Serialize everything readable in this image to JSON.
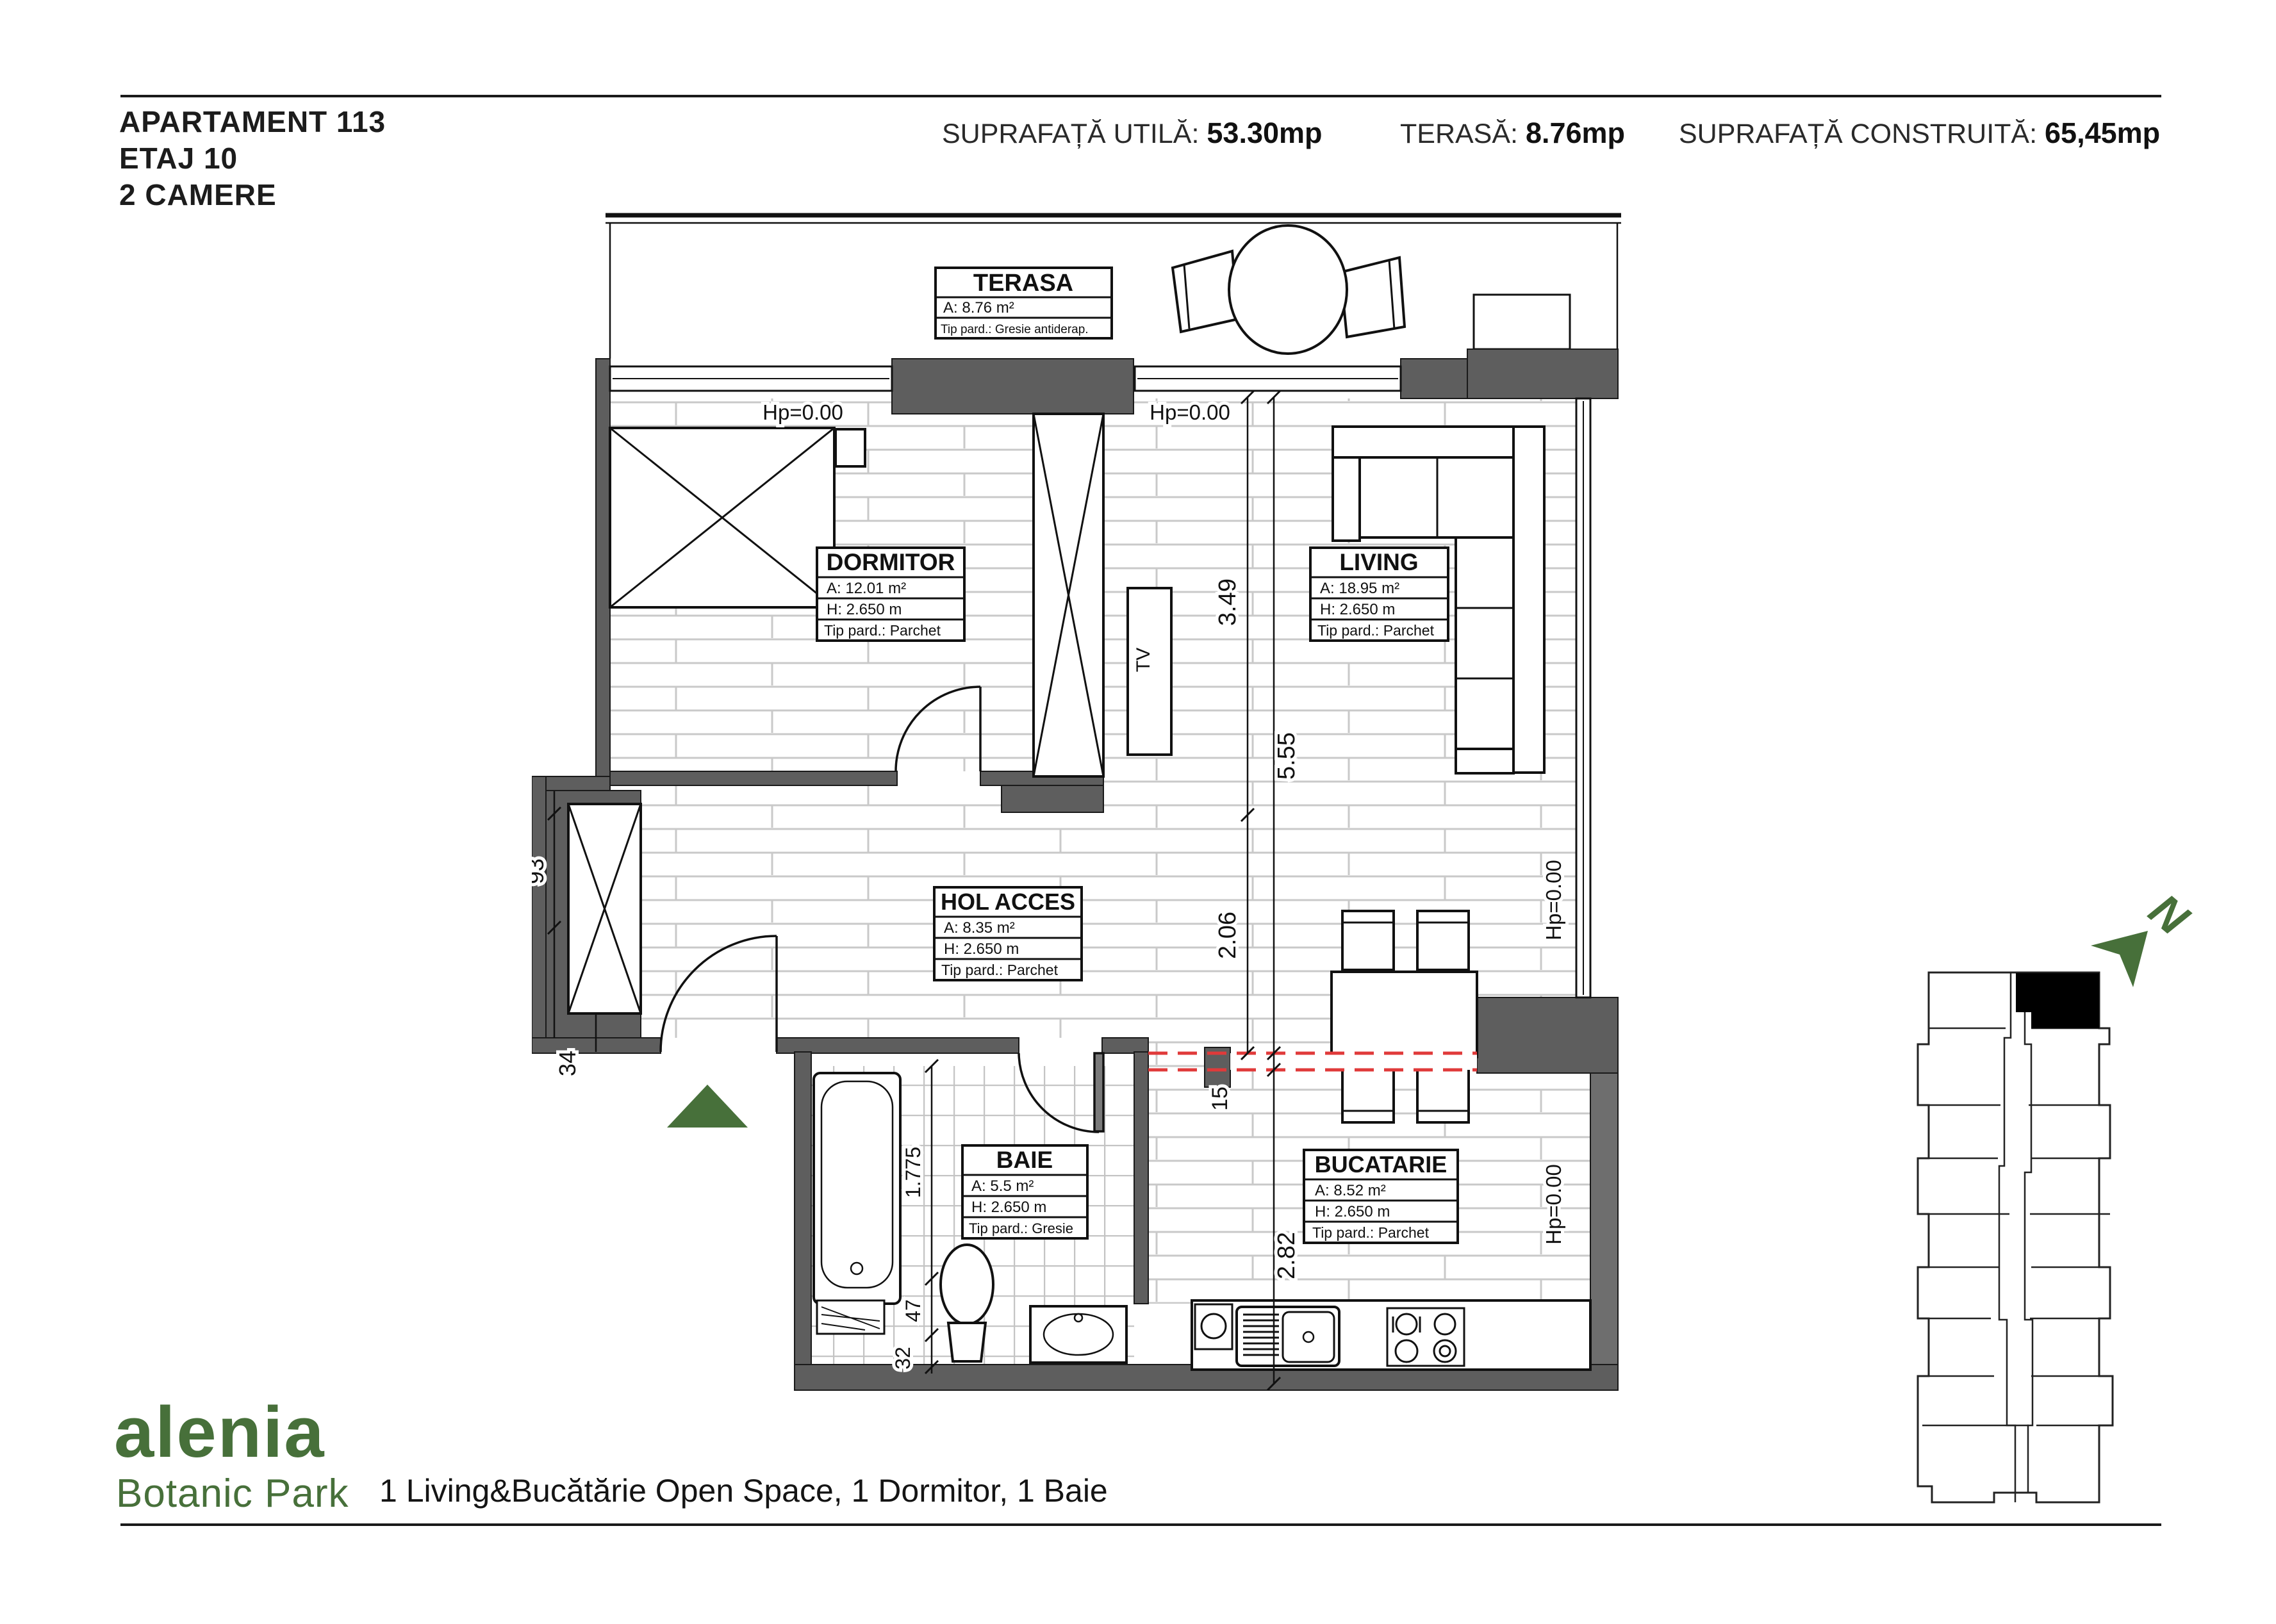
{
  "header": {
    "apartment": "APARTAMENT 113",
    "floor": "ETAJ 10",
    "rooms_count": "2 CAMERE",
    "stats": [
      {
        "label": "SUPRAFAȚĂ UTILĂ:",
        "value": "53.30mp"
      },
      {
        "label": "TERASĂ:",
        "value": "8.76mp"
      },
      {
        "label": "SUPRAFAȚĂ CONSTRUITĂ:",
        "value": "65,45mp"
      }
    ]
  },
  "plan": {
    "rooms": [
      {
        "name": "TERASA",
        "area": "A: 8.76 m²",
        "floor_type": "Tip pard.: Gresie antiderap."
      },
      {
        "name": "DORMITOR",
        "area": "A: 12.01 m²",
        "height": "H: 2.650 m",
        "floor_type": "Tip pard.: Parchet"
      },
      {
        "name": "LIVING",
        "area": "A: 18.95 m²",
        "height": "H: 2.650 m",
        "floor_type": "Tip pard.: Parchet"
      },
      {
        "name": "HOL ACCES",
        "area": "A: 8.35 m²",
        "height": "H: 2.650 m",
        "floor_type": "Tip pard.: Parchet"
      },
      {
        "name": "BAIE",
        "area": "A: 5.5 m²",
        "height": "H: 2.650 m",
        "floor_type": "Tip pard.: Gresie"
      },
      {
        "name": "BUCATARIE",
        "area": "A: 8.52 m²",
        "height": "H: 2.650 m",
        "floor_type": "Tip pard.: Parchet"
      }
    ],
    "levels": {
      "hp_top_left": "Hp=0.00",
      "hp_top_right": "Hp=0.00",
      "hp_right_upper": "Hp=0.00",
      "hp_right_lower": "Hp=0.00"
    },
    "dimensions": {
      "v1": "3.49",
      "v2": "5.55",
      "v3": "2.06",
      "v4": "15",
      "v5": "2.82",
      "left_upper": "93",
      "left_lower": "34",
      "bath_v1": "1.775",
      "bath_v2": "47",
      "bath_v3": "32"
    },
    "tv_label": "TV",
    "north_label": "N"
  },
  "footer": {
    "brand": "alenia",
    "brand_sub": "Botanic Park",
    "description": "1 Living&Bucătărie Open Space, 1 Dormitor, 1 Baie"
  },
  "colors": {
    "accent_green": "#47703a",
    "wall_gray": "#5e5e5e",
    "marker_red": "#e03a3a"
  }
}
